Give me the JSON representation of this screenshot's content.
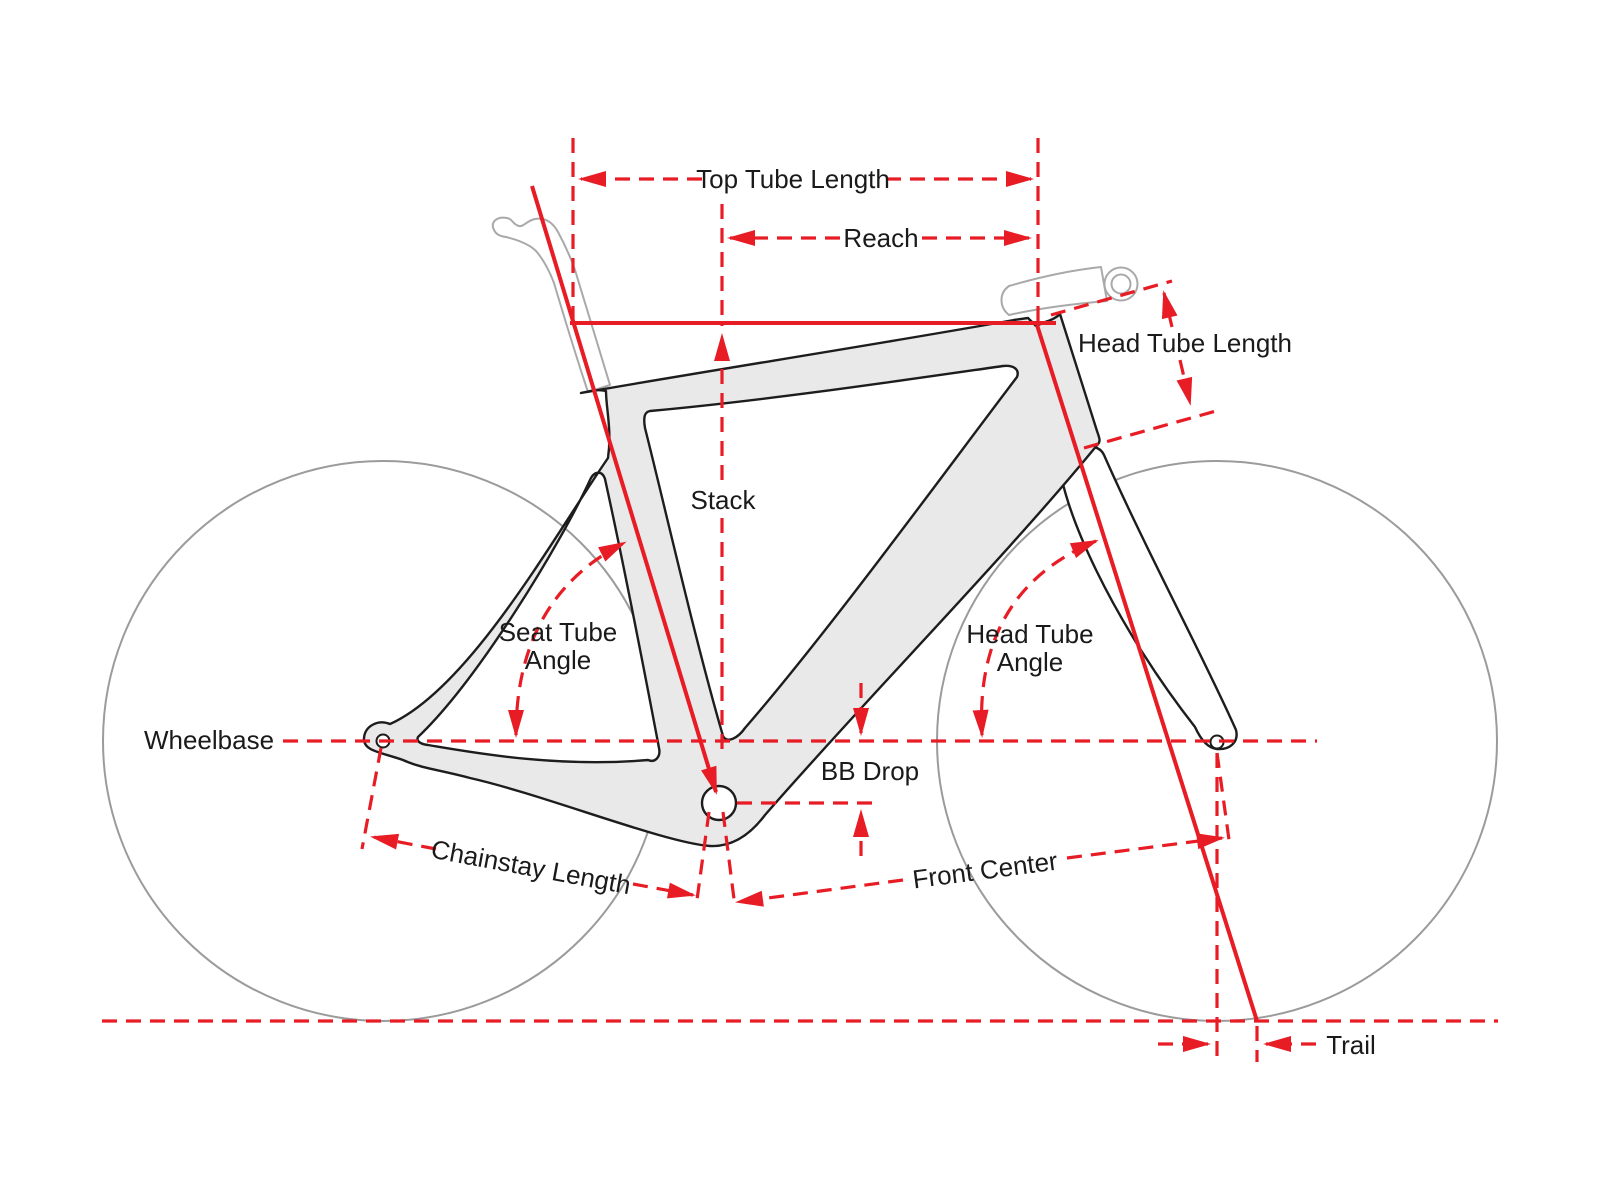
{
  "diagram": {
    "type": "bicycle-frame-geometry",
    "labels": {
      "top_tube_length": "Top Tube Length",
      "reach": "Reach",
      "head_tube_length": "Head Tube Length",
      "stack": "Stack",
      "seat_tube_angle": {
        "line1": "Seat Tube",
        "line2": "Angle"
      },
      "head_tube_angle": {
        "line1": "Head Tube",
        "line2": "Angle"
      },
      "wheelbase": "Wheelbase",
      "bb_drop": "BB Drop",
      "chainstay_length": "Chainstay Length",
      "front_center": "Front Center",
      "trail": "Trail"
    },
    "colors": {
      "dimension_red": "#e81c24",
      "frame_fill": "#e9e9e9",
      "frame_outline": "#1d1d1d",
      "wheel_gray": "#9b9b9b",
      "component_gray": "#a9a9a9",
      "label_color": "#1a1a1a",
      "background": "#ffffff"
    }
  }
}
